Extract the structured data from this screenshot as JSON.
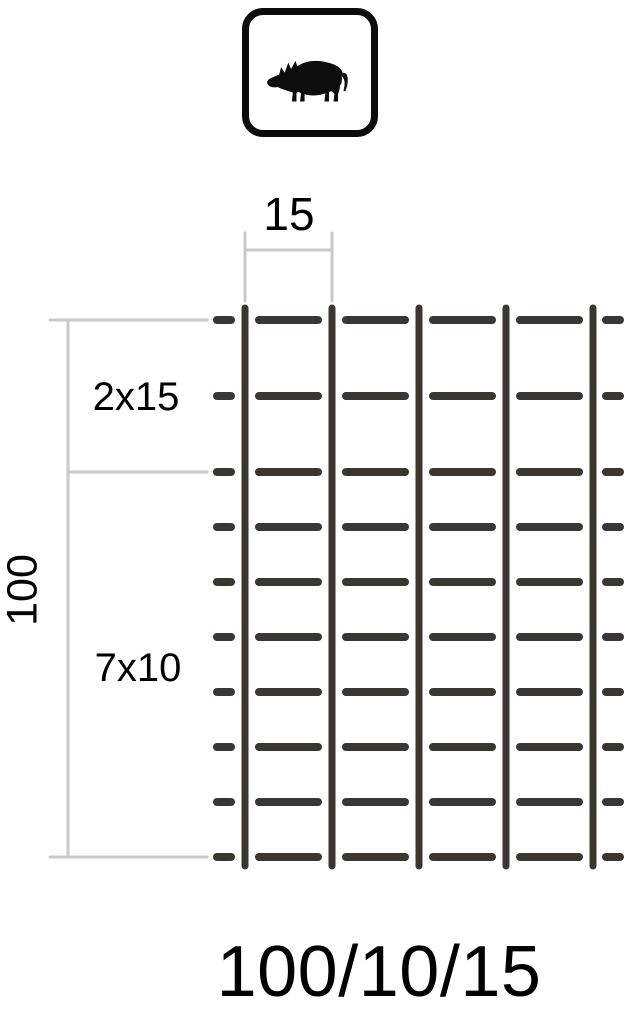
{
  "diagram": {
    "title": "wildlife fence mesh specification",
    "product_code": "100/10/15"
  },
  "icon": {
    "name": "wild-boar",
    "fill_color": "#0d0d0d",
    "box_border_color": "#0c0c0c"
  },
  "labels": {
    "top_width": "15",
    "upper_section": "2x15",
    "total_height": "100",
    "lower_section": "7x10",
    "product_code": "100/10/15"
  },
  "mesh": {
    "vertical_wires": 5,
    "horizontal_wires": 10,
    "upper_gaps_count": 2,
    "upper_gap_size_cm": 15,
    "lower_gaps_count": 7,
    "lower_gap_size_cm": 10,
    "height_cm": 100,
    "vertical_spacing_cm": 15,
    "wire_color": "#3a3632",
    "dimension_line_color": "#cacaca",
    "background_color": "#ffffff",
    "text_color": "#000000"
  }
}
